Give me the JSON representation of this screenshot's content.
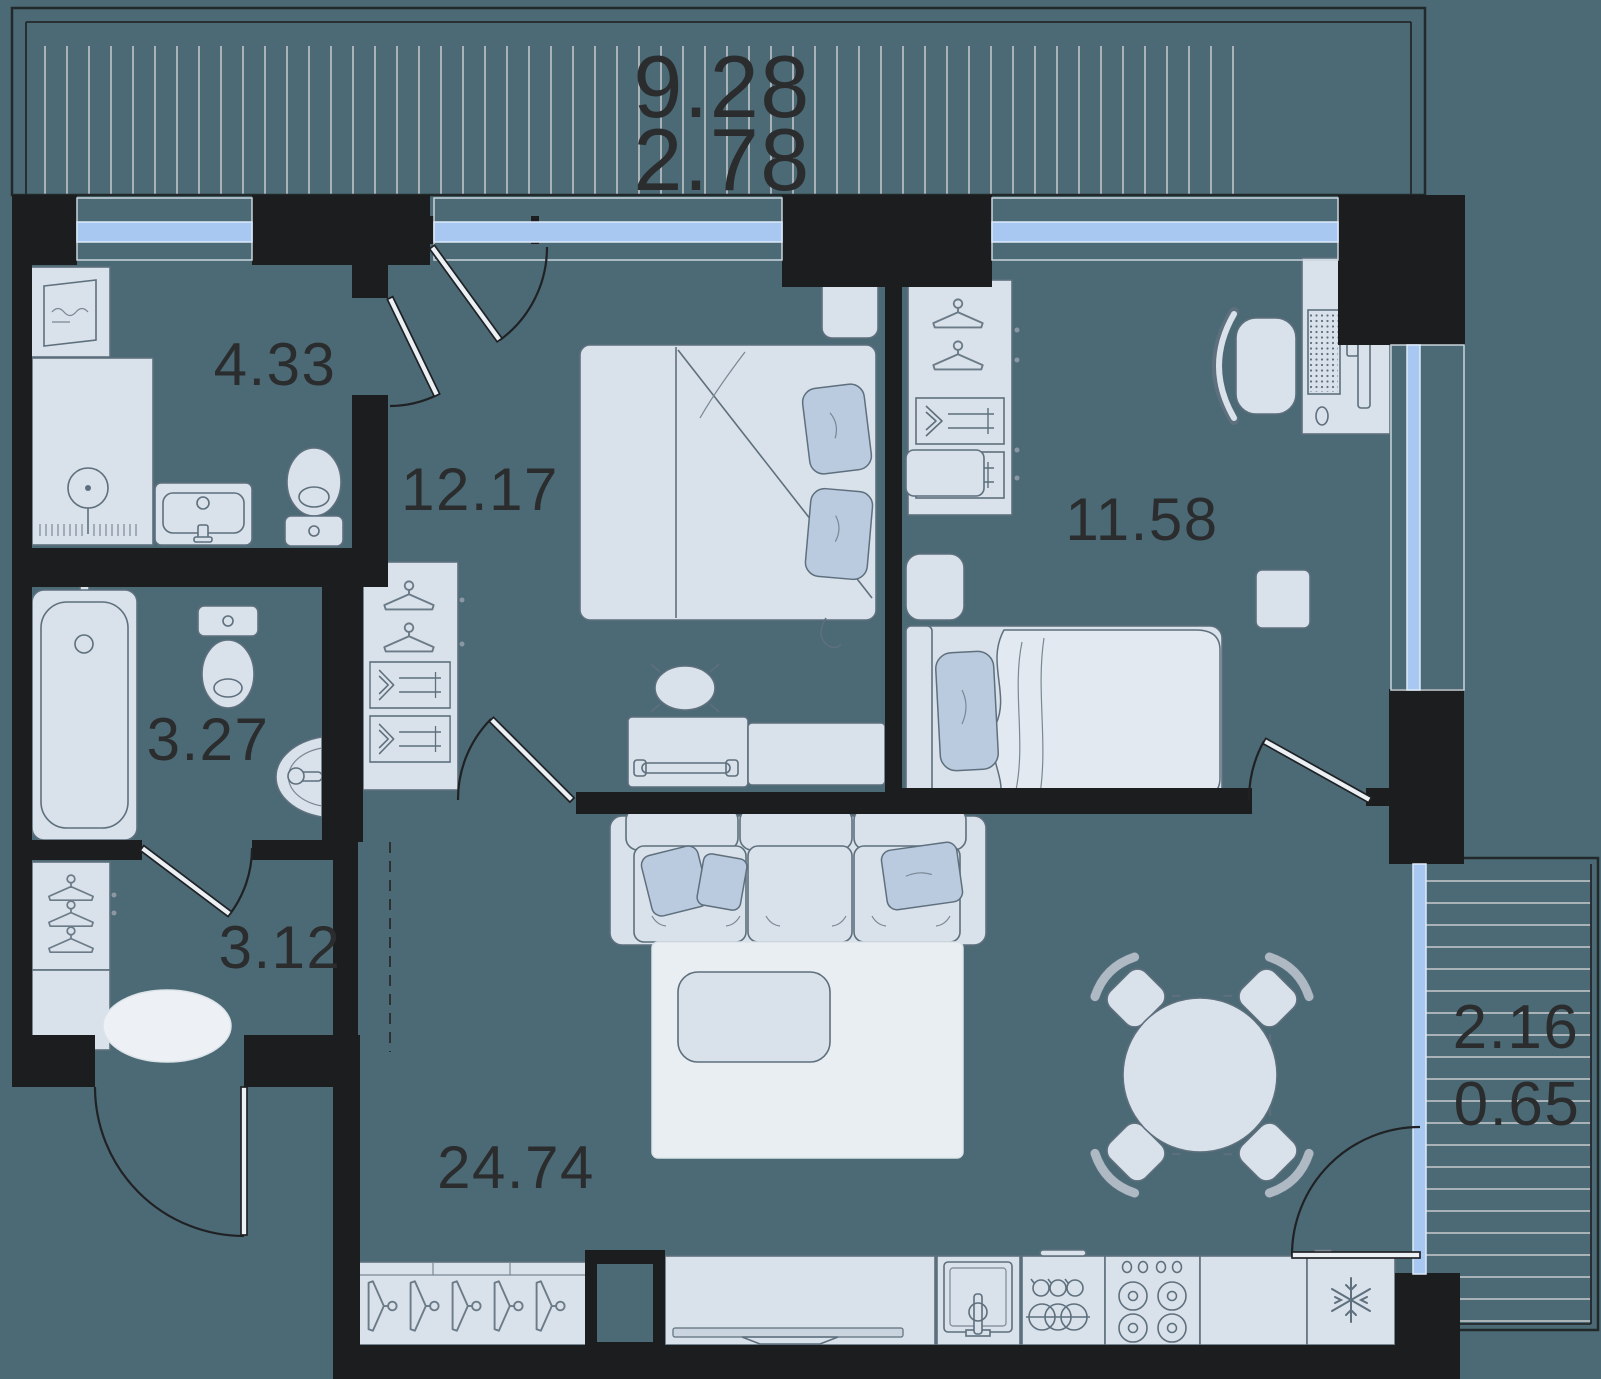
{
  "floor_plan": {
    "top_balcony": {
      "area": "9.28",
      "secondary_area": "2.78"
    },
    "right_balcony": {
      "area": "2.16",
      "secondary_area": "0.65"
    },
    "rooms": [
      {
        "name": "bathroom-shower",
        "area": "4.33"
      },
      {
        "name": "bedroom-master",
        "area": "12.17"
      },
      {
        "name": "bedroom-second",
        "area": "11.58"
      },
      {
        "name": "bathroom-tub",
        "area": "3.27"
      },
      {
        "name": "hallway",
        "area": "3.12"
      },
      {
        "name": "living-kitchen",
        "area": "24.74"
      }
    ],
    "colors": {
      "background": "#4B6A75",
      "walls": "#1C1D1F",
      "furniture_fill": "#D9E1EA",
      "furniture_stroke": "#5E6F7D",
      "window_glass": "#A8C8F2",
      "pillow": "#BACBDF",
      "rug": "#EDF1F6",
      "hatch_line": "#A9B2B6",
      "label_text": "#2B2C2D"
    }
  }
}
